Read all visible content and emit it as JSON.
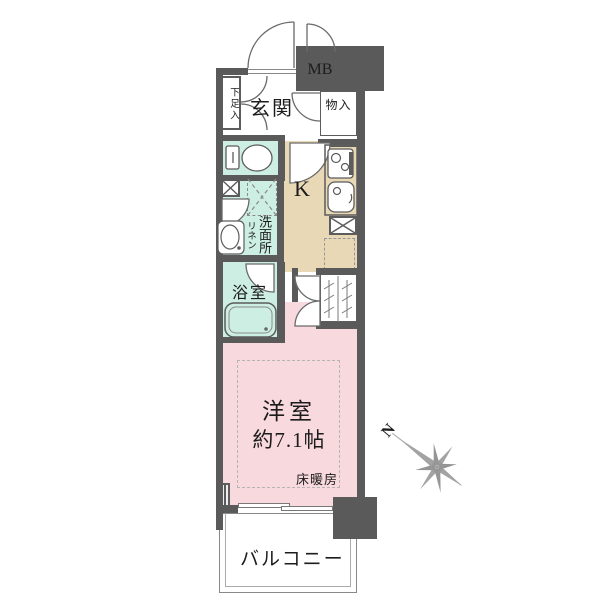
{
  "colors": {
    "wall": "#5a5a5a",
    "wet": "#cdeee2",
    "kitchen": "#e9d8b6",
    "main": "#f8d9de",
    "line": "#5c5c5c",
    "thin": "#888888",
    "compass": "#a3a3a3",
    "text": "#1c1c1c"
  },
  "rooms": {
    "entrance": {
      "label": "玄関"
    },
    "shoe_cabinet": {
      "label": "下足入"
    },
    "meter_box": {
      "label": "MB"
    },
    "storage": {
      "label": "物入"
    },
    "kitchen": {
      "label": "K"
    },
    "washroom": {
      "label": "洗面所"
    },
    "linen": {
      "label": "リネン"
    },
    "bathroom": {
      "label": "浴室"
    },
    "main_room": {
      "label": "洋室",
      "size": "約7.1帖",
      "floor_heating": "床暖房"
    },
    "balcony": {
      "label": "バルコニー"
    }
  },
  "compass": {
    "label": "N"
  }
}
